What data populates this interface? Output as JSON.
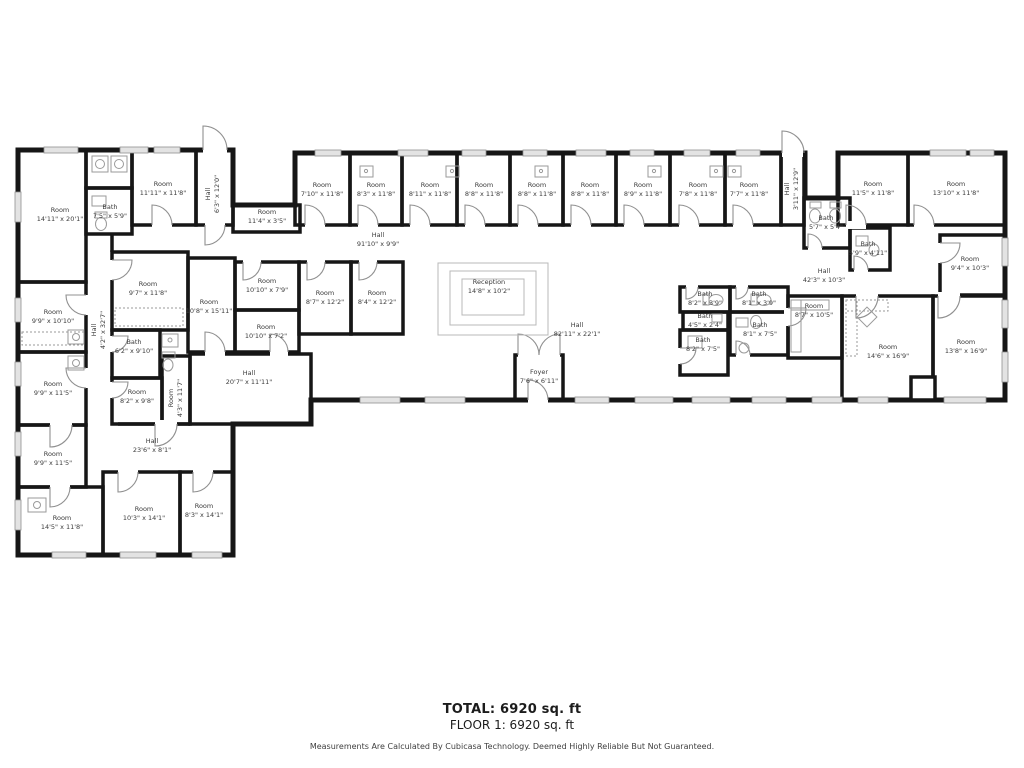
{
  "floorplan": {
    "wall_color": "#161616",
    "window_color": "#e3e3e3",
    "labels": [
      {
        "name": "Room",
        "dims": "14'11\" x 20'1\""
      },
      {
        "name": "Bath",
        "dims": "7'5\" x 5'9\""
      },
      {
        "name": "Room",
        "dims": "11'11\" x 11'8\""
      },
      {
        "name": "Hall",
        "dims": "6'3\" x 12'0\""
      },
      {
        "name": "Room",
        "dims": "11'4\" x 3'5\""
      },
      {
        "name": "Room",
        "dims": "7'10\" x 11'8\""
      },
      {
        "name": "Room",
        "dims": "8'3\" x 11'8\""
      },
      {
        "name": "Room",
        "dims": "8'11\" x 11'8\""
      },
      {
        "name": "Room",
        "dims": "8'8\" x 11'8\""
      },
      {
        "name": "Room",
        "dims": "8'8\" x 11'8\""
      },
      {
        "name": "Room",
        "dims": "8'8\" x 11'8\""
      },
      {
        "name": "Room",
        "dims": "8'9\" x 11'8\""
      },
      {
        "name": "Room",
        "dims": "7'8\" x 11'8\""
      },
      {
        "name": "Room",
        "dims": "7'7\" x 11'8\""
      },
      {
        "name": "Hall",
        "dims": "3'11\" x 12'9\""
      },
      {
        "name": "Room",
        "dims": "11'5\" x 11'8\""
      },
      {
        "name": "Room",
        "dims": "13'10\" x 11'8\""
      },
      {
        "name": "Hall",
        "dims": "91'10\" x 9'9\""
      },
      {
        "name": "Bath",
        "dims": "5'7\" x 5'4\""
      },
      {
        "name": "Bath",
        "dims": "5'9\" x 4'11\""
      },
      {
        "name": "Hall",
        "dims": "42'3\" x 10'3\""
      },
      {
        "name": "Room",
        "dims": "9'4\" x 10'3\""
      },
      {
        "name": "Room",
        "dims": "9'7\" x 11'8\""
      },
      {
        "name": "Room",
        "dims": "10'8\" x 15'11\""
      },
      {
        "name": "Room",
        "dims": "9'9\" x 10'10\""
      },
      {
        "name": "Hall",
        "dims": "4'2\" x 32'7\""
      },
      {
        "name": "Room",
        "dims": "10'10\" x 7'9\""
      },
      {
        "name": "Room",
        "dims": "8'7\" x 12'2\""
      },
      {
        "name": "Room",
        "dims": "8'4\" x 12'2\""
      },
      {
        "name": "Reception",
        "dims": "14'8\" x 10'2\""
      },
      {
        "name": "Bath",
        "dims": "8'2\" x 3'9\""
      },
      {
        "name": "Bath",
        "dims": "8'1\" x 3'9\""
      },
      {
        "name": "Room",
        "dims": "8'7\" x 10'5\""
      },
      {
        "name": "Bath",
        "dims": "4'5\" x 2'4\""
      },
      {
        "name": "Bath",
        "dims": "8'1\" x 7'5\""
      },
      {
        "name": "Bath",
        "dims": "8'2\" x 7'5\""
      },
      {
        "name": "Hall",
        "dims": "82'11\" x 22'1\""
      },
      {
        "name": "Bath",
        "dims": "6'2\" x 9'10\""
      },
      {
        "name": "Room",
        "dims": "10'10\" x 7'2\""
      },
      {
        "name": "Room",
        "dims": "9'9\" x 11'5\""
      },
      {
        "name": "Room",
        "dims": "8'2\" x 9'8\""
      },
      {
        "name": "Room",
        "dims": "4'3\" x 11'7\""
      },
      {
        "name": "Hall",
        "dims": "20'7\" x 11'11\""
      },
      {
        "name": "Room",
        "dims": "14'6\" x 16'9\""
      },
      {
        "name": "Room",
        "dims": "13'8\" x 16'9\""
      },
      {
        "name": "Foyer",
        "dims": "7'6\" x 6'11\""
      },
      {
        "name": "Hall",
        "dims": "23'6\" x 8'1\""
      },
      {
        "name": "Room",
        "dims": "9'9\" x 11'5\""
      },
      {
        "name": "Room",
        "dims": "14'5\" x 11'8\""
      },
      {
        "name": "Room",
        "dims": "10'3\" x 14'1\""
      },
      {
        "name": "Room",
        "dims": "8'3\" x 14'1\""
      }
    ],
    "footer": {
      "total": "TOTAL: 6920 sq. ft",
      "floor": "FLOOR 1: 6920 sq. ft",
      "disclaimer": "Measurements Are Calculated By Cubicasa Technology. Deemed Highly Reliable But Not Guaranteed."
    }
  }
}
